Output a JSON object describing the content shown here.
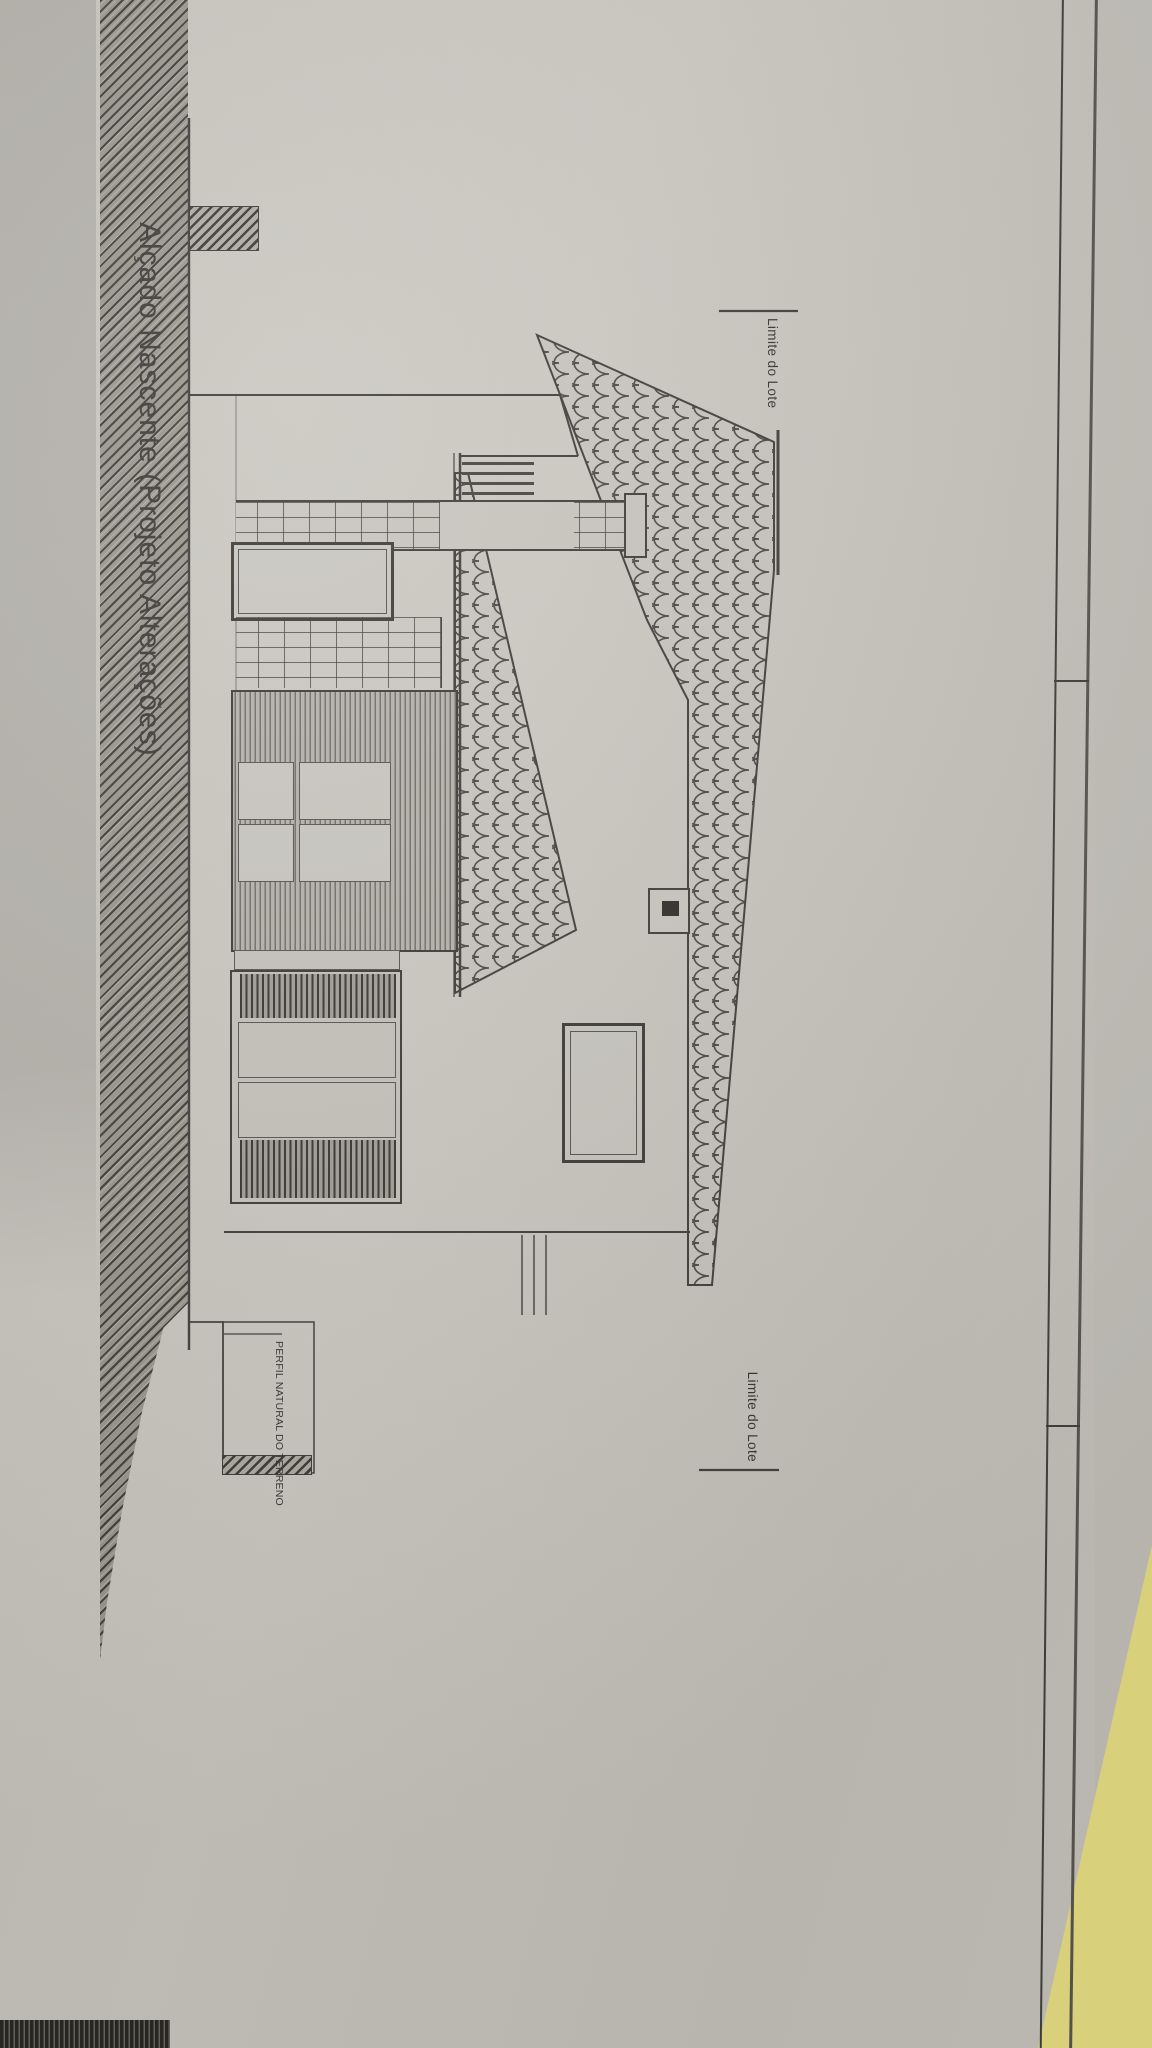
{
  "sheet": {
    "title": "Alçado Nascente (Projeto Alterações)",
    "labels": {
      "lot_limit_left": "Limite do Lote",
      "lot_limit_right": "Limite do Lote",
      "terrain_profile": "PERFIL NATURAL DO TERRENO"
    }
  },
  "colors": {
    "paper": "#c9c6bf",
    "desk_background": "#b4b1ab",
    "drawing_line": "#3e3d39",
    "earth_hatch": "#99968d",
    "roof_tile_line": "#4a4844",
    "sticky_note_yellow": "#eae183",
    "dark_object": "#25241f"
  }
}
